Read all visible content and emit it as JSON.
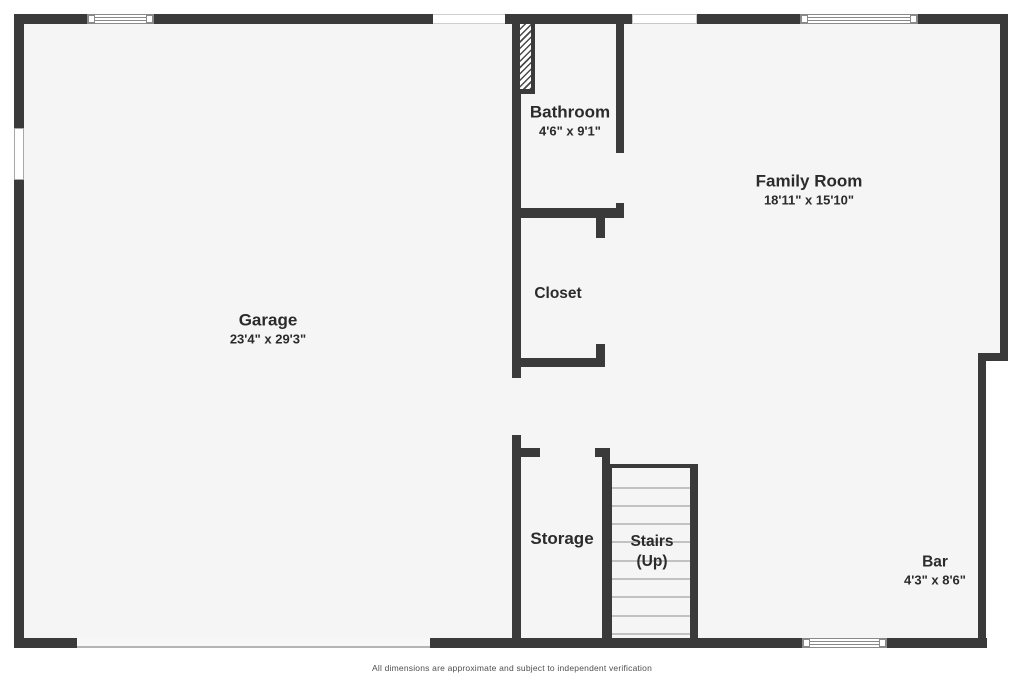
{
  "plan": {
    "rooms": {
      "garage": {
        "name": "Garage",
        "dims": "23'4\" x 29'3\""
      },
      "bathroom": {
        "name": "Bathroom",
        "dims": "4'6\" x 9'1\""
      },
      "family_room": {
        "name": "Family Room",
        "dims": "18'11\" x 15'10\""
      },
      "closet": {
        "name": "Closet"
      },
      "storage": {
        "name": "Storage"
      },
      "stairs": {
        "name": "Stairs",
        "direction": "(Up)"
      },
      "bar": {
        "name": "Bar",
        "dims": "4'3\" x 8'6\""
      }
    },
    "footer": "All dimensions are approximate and subject to independent verification",
    "colors": {
      "wall": "#3a3a3a",
      "floor": "#f5f5f5",
      "background": "#ffffff",
      "label_text": "#2b2b2b",
      "footer_text": "#4f4f4f"
    }
  }
}
